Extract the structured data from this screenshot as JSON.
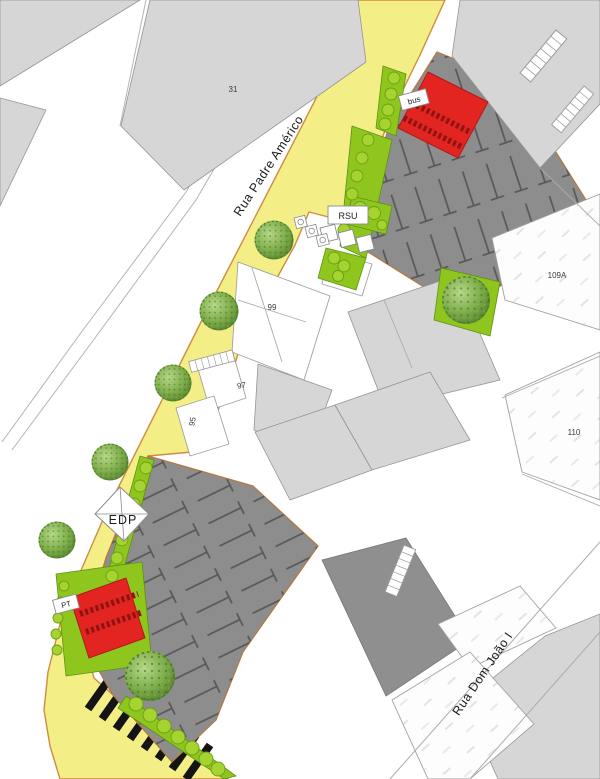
{
  "plan": {
    "streets": {
      "padre_americo": "Rua Padre Américo",
      "dom_joao": "Rua Dom João I"
    },
    "labels": {
      "building_31": "31",
      "building_99": "99",
      "building_97": "97",
      "building_95": "95",
      "building_109a": "109A",
      "building_110": "110",
      "transformer": "EDP",
      "waste": "RSU",
      "bus_stop": "bus",
      "pt_box": "PT"
    },
    "colors": {
      "sidewalk_yellow": "#f3ef86",
      "curb_orange": "#cf8b44",
      "parking_gray": "#8d8d8d",
      "stall_line_gray": "#575757",
      "building_light_gray": "#d6d6d6",
      "building_white": "#ffffff",
      "proposed_red": "#e32521",
      "green_area": "#8fc61e",
      "tree_green": "#6f9c3e",
      "crosswalk_black": "#141414"
    }
  }
}
